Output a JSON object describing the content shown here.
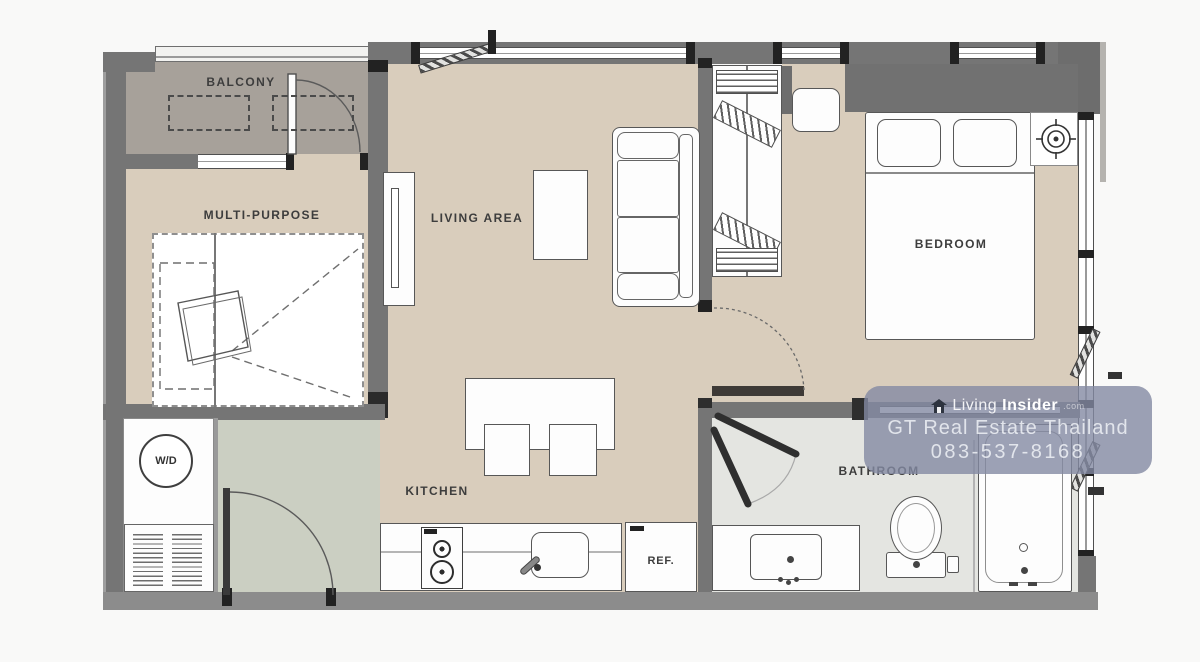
{
  "floorplan": {
    "rooms": {
      "balcony": {
        "label": "BALCONY"
      },
      "multi_purpose": {
        "label": "MULTI-PURPOSE"
      },
      "living_area": {
        "label": "LIVING AREA"
      },
      "kitchen": {
        "label": "KITCHEN"
      },
      "bedroom": {
        "label": "BEDROOM"
      },
      "bathroom": {
        "label": "BATHROOM"
      }
    },
    "fixtures": {
      "washer_dryer_label": "W/D",
      "refrigerator_label": "REF."
    },
    "colors": {
      "wall": "#757575",
      "wall_bottom": "#8c8c8c",
      "floor_main": "#d9cdbc",
      "floor_balcony": "#a7a19a",
      "floor_entry": "#cbcfc2",
      "floor_bathroom": "#e4e5e1",
      "label_text": "#3d3d3d",
      "watermark_bg": "#838aa2"
    }
  },
  "watermark": {
    "brand_word1": "Living",
    "brand_word2": "Insider",
    "brand_suffix": ".com",
    "line2": "GT Real Estate Thailand",
    "line3": "083-537-8168"
  }
}
